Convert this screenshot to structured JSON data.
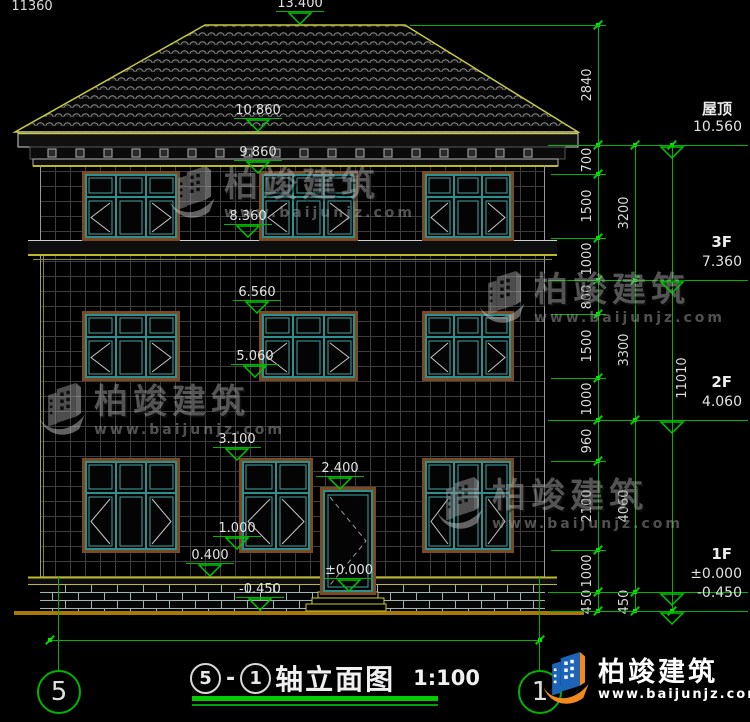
{
  "drawing_type": "建筑立面图",
  "colors": {
    "dim_green": "#00b400",
    "bright_green": "#00e800",
    "text_white": "#dcdcdc",
    "outline_yellow": "#b9b92a",
    "roof_line": "#c9c93d",
    "window_teal": "#2e8f8f",
    "frame_brown": "#7a4a22",
    "ground_orange": "#a87808"
  },
  "facade_markers": [
    {
      "label": "13.400",
      "x": 300,
      "tip": 25
    },
    {
      "label": "10.860",
      "x": 258,
      "tip": 132
    },
    {
      "label": "9.860",
      "x": 258,
      "tip": 174
    },
    {
      "label": "8.360",
      "x": 248,
      "tip": 238
    },
    {
      "label": "6.560",
      "x": 257,
      "tip": 314
    },
    {
      "label": "5.060",
      "x": 255,
      "tip": 378
    },
    {
      "label": "3.100",
      "x": 237,
      "tip": 461
    },
    {
      "label": "2.400",
      "x": 340,
      "tip": 490
    },
    {
      "label": "1.000",
      "x": 237,
      "tip": 550
    },
    {
      "label": "0.400",
      "x": 210,
      "tip": 577
    },
    {
      "label": "±0.000",
      "x": 349,
      "tip": 592
    },
    {
      "label": "-0.450",
      "x": 260,
      "tip": 611
    }
  ],
  "levels": [
    {
      "name": "屋顶",
      "label": "10.560",
      "y": 145
    },
    {
      "name": "3F",
      "label": "7.360",
      "y": 280
    },
    {
      "name": "2F",
      "label": "4.060",
      "y": 420
    },
    {
      "name": "1F",
      "label": "±0.000",
      "y": 592
    },
    {
      "name": "",
      "label": "-0.450",
      "y": 611
    }
  ],
  "chains": [
    {
      "x": 598,
      "tside": "left",
      "segments": [
        {
          "label": "2840",
          "a": 25,
          "b": 145
        },
        {
          "label": "700",
          "a": 145,
          "b": 174
        },
        {
          "label": "1500",
          "a": 174,
          "b": 238
        },
        {
          "label": "1000",
          "a": 238,
          "b": 280
        },
        {
          "label": "800",
          "a": 280,
          "b": 314
        },
        {
          "label": "1500",
          "a": 314,
          "b": 378
        },
        {
          "label": "1000",
          "a": 378,
          "b": 420
        },
        {
          "label": "960",
          "a": 420,
          "b": 461
        },
        {
          "label": "2100",
          "a": 461,
          "b": 550
        },
        {
          "label": "1000",
          "a": 550,
          "b": 592
        },
        {
          "label": "450",
          "a": 592,
          "b": 611
        }
      ]
    },
    {
      "x": 635,
      "tside": "left",
      "segments": [
        {
          "label": "3200",
          "a": 145,
          "b": 280
        },
        {
          "label": "3300",
          "a": 280,
          "b": 420
        },
        {
          "label": "4060",
          "a": 420,
          "b": 592
        },
        {
          "label": "450",
          "a": 592,
          "b": 611
        }
      ]
    },
    {
      "x": 672,
      "tside": "right",
      "segments": [
        {
          "label": "11010",
          "a": 145,
          "b": 611
        }
      ]
    }
  ],
  "bottom_dim": {
    "label": "11360",
    "a": 50,
    "b": 540,
    "y": 640
  },
  "axes": [
    {
      "label": "5",
      "cx": 58
    },
    {
      "label": "1",
      "cx": 539
    }
  ],
  "title": {
    "axis_a": "5",
    "dash": "-",
    "axis_b": "1",
    "name": "轴立面图",
    "scale": "1:100"
  },
  "watermark": {
    "name": "柏竣建筑",
    "url": "www.baijunjz.com"
  },
  "logo": {
    "name": "柏竣建筑",
    "url": "www.baijunjz.com"
  }
}
